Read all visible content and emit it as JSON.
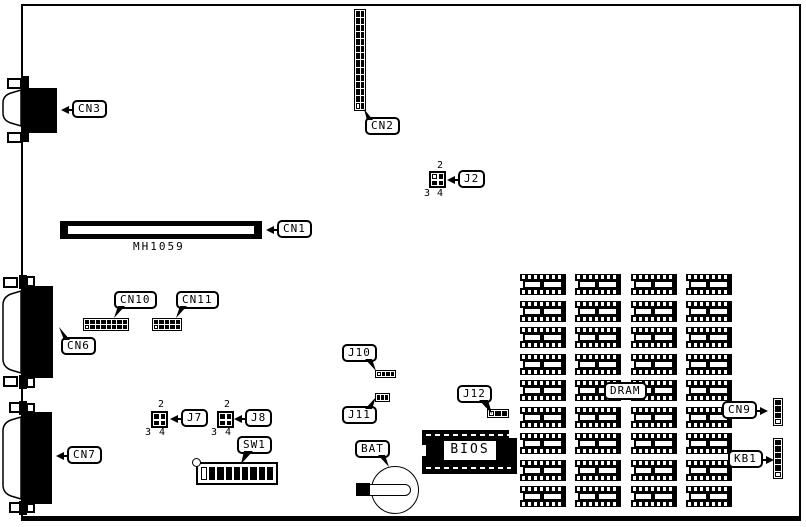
{
  "diagram": {
    "type": "motherboard-layout",
    "colors": {
      "ink": "#000000",
      "paper": "#ffffff"
    }
  },
  "components": {
    "cn3": {
      "label": "CN3"
    },
    "cn2": {
      "label": "CN2"
    },
    "j2": {
      "label": "J2",
      "pin_top": "2",
      "pin_bottom_left": "3",
      "pin_bottom_right": "4"
    },
    "cn1": {
      "label": "CN1",
      "part_number": "MH1059"
    },
    "cn10": {
      "label": "CN10"
    },
    "cn11": {
      "label": "CN11"
    },
    "cn6": {
      "label": "CN6"
    },
    "j10": {
      "label": "J10"
    },
    "j11": {
      "label": "J11"
    },
    "j7": {
      "label": "J7",
      "pin_top": "2",
      "pin_bottom_left": "3",
      "pin_bottom_right": "4"
    },
    "j8": {
      "label": "J8",
      "pin_top": "2",
      "pin_bottom_left": "3",
      "pin_bottom_right": "4"
    },
    "sw1": {
      "label": "SW1",
      "switch_positions": 8
    },
    "cn7": {
      "label": "CN7"
    },
    "bat": {
      "label": "BAT"
    },
    "j12": {
      "label": "J12"
    },
    "bios": {
      "label": "BIOS"
    },
    "dram": {
      "label": "DRAM",
      "columns": 4,
      "rows": 9
    },
    "cn9": {
      "label": "CN9"
    },
    "kb1": {
      "label": "KB1"
    }
  }
}
